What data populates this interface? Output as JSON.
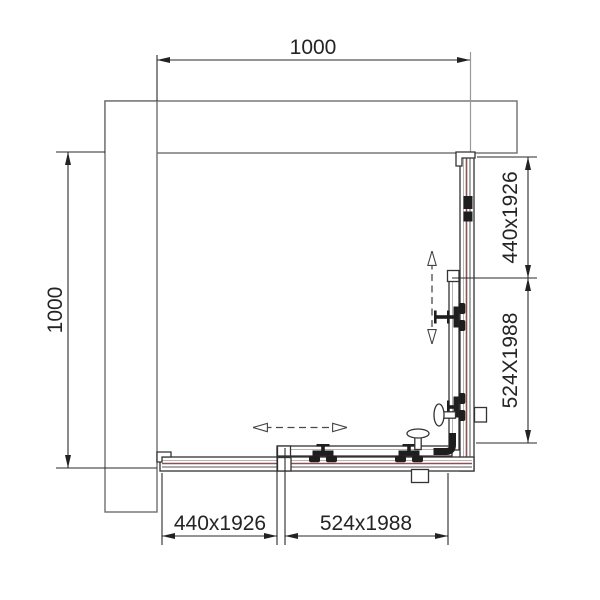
{
  "dims": {
    "top": "1000",
    "left": "1000",
    "right_upper": "440x1926",
    "right_lower": "524X1988",
    "bottom_left": "440x1926",
    "bottom_right": "524x1988"
  },
  "icons": {
    "slide_arrow_horizontal": "double-headed-dashed-arrow",
    "slide_arrow_vertical": "double-headed-dashed-arrow",
    "roller": "door-roller-carriage",
    "knob": "mushroom-handle"
  },
  "colors": {
    "line": "#333333",
    "wall": "#6e6e6e",
    "glass": "#8a5252",
    "dimension_text": "#242424",
    "dashed_arrow": "#4a4a4a",
    "background": "#ffffff"
  }
}
